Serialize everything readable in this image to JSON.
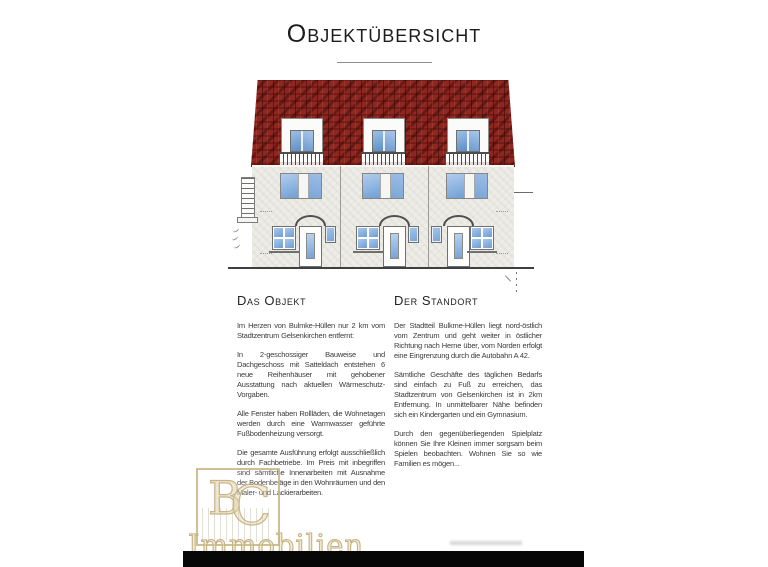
{
  "document": {
    "title": "Objektübersicht"
  },
  "sections": [
    {
      "heading": "Das Objekt",
      "paragraphs": [
        "Im Herzen von Bulmke-Hüllen nur 2 km vom Stadtzentrum Gelsenkirchen entfernt:",
        "In 2-geschossiger Bauweise und Dachgeschoss mit Satteldach entstehen 6 neue Reihenhäuser mit gehobener Ausstattung nach aktuellen Wärmeschutz-Vorgaben.",
        "Alle Fenster haben Rollläden, die Wohnetagen werden durch eine Warmwasser geführte Fußbodenheizung versorgt.",
        "Die gesamte Ausführung erfolgt ausschließlich durch Fachbetriebe. Im Preis mit inbegriffen sind sämtliche Innenarbeiten mit Ausnahme der Bodenbeläge in den Wohnräumen und den Maler- und Lackierarbeiten."
      ]
    },
    {
      "heading": "Der Standort",
      "paragraphs": [
        "Der Stadtteil Bulkme-Hüllen liegt nord-östlich vom Zentrum und geht weiter in östlicher Richtung nach Herne über, vom Norden erfolgt eine Eingrenzung durch die Autobahn A 42.",
        "Sämtliche Geschäfte des täglichen Bedarfs sind einfach zu Fuß zu erreichen, das Stadtzentrum von Gelsenkirchen ist in 2km Entfernung. In unmittelbarer Nähe befinden sich ein Kindergarten und ein Gymnasium.",
        "Durch den gegenüberliegenden Spielplatz können Sie Ihre Kleinen immer sorgsam beim Spielen beobachten. Wohnen Sie so wie Familien es mögen..."
      ]
    }
  ],
  "watermark": {
    "monogram_b": "B",
    "monogram_c": "C",
    "caption": "Immobilien",
    "color": "#c2ae7c"
  },
  "colors": {
    "roof_red": "#8f2721",
    "facade_gray": "#edece7",
    "window_blue": "#7ea9d8",
    "ground_line": "#3f3f3f",
    "text": "#3a3a3a"
  }
}
